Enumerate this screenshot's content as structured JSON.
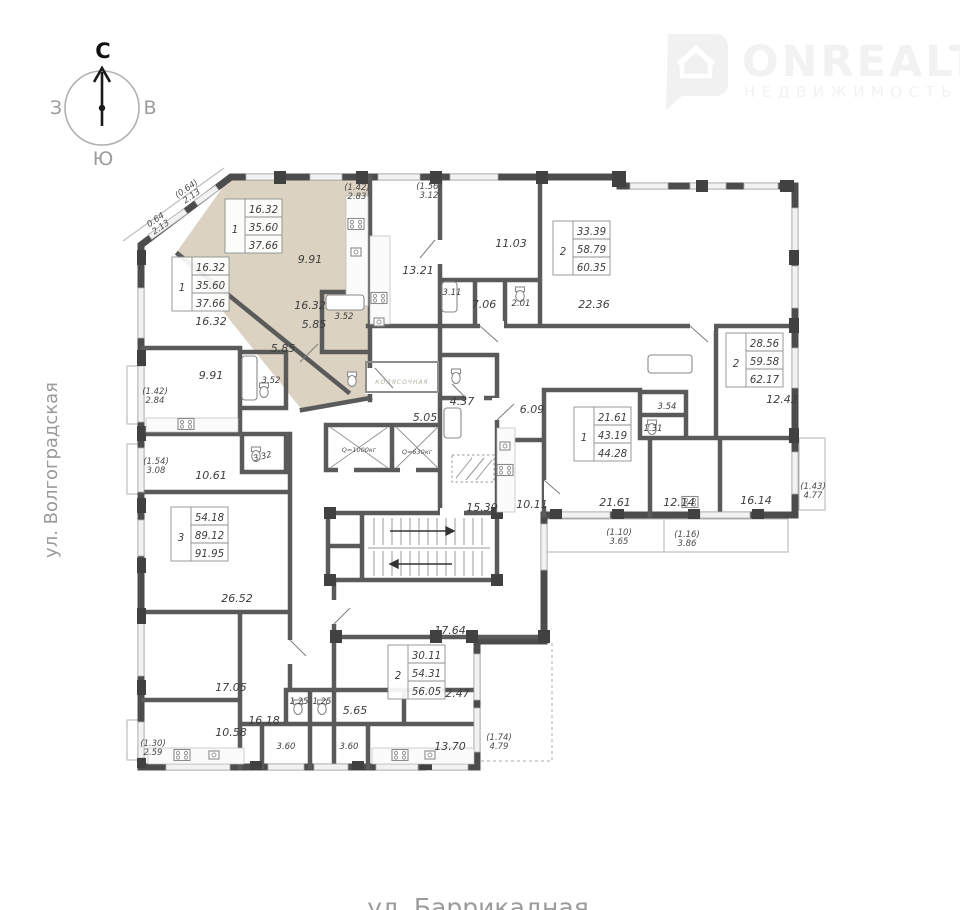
{
  "compass": {
    "north": "С",
    "east": "В",
    "south": "Ю",
    "west": "З"
  },
  "watermark": {
    "brand": "ONREALT",
    "tagline": "НЕДВИЖИМОСТЬ"
  },
  "streets": {
    "left": "ул. Волгоградская",
    "bottom": "ул. Баррикадная"
  },
  "colors": {
    "wall": "#4c4c4c",
    "highlight": "#dbd2c2",
    "label": "#3e3e3c",
    "muted": "#9b9b9b"
  },
  "apartments": {
    "a": {
      "rooms": "1",
      "living": "16.32",
      "area": "35.60",
      "total": "37.66"
    },
    "b": {
      "rooms": "1",
      "living": "16.32",
      "area": "35.60",
      "total": "37.66"
    },
    "c": {
      "rooms": "2",
      "living": "33.39",
      "area": "58.79",
      "total": "60.35"
    },
    "d": {
      "rooms": "2",
      "living": "28.56",
      "area": "59.58",
      "total": "62.17"
    },
    "e": {
      "rooms": "1",
      "living": "21.61",
      "area": "43.19",
      "total": "44.28"
    },
    "f": {
      "rooms": "2",
      "living": "30.11",
      "area": "54.31",
      "total": "56.05"
    },
    "g": {
      "rooms": "3",
      "living": "54.18",
      "area": "89.12",
      "total": "91.95"
    }
  },
  "rooms": {
    "a_living": "16.32",
    "a_kitchen": "9.91",
    "a_hall": "5.85",
    "a_bath": "3.52",
    "b_room": "16.32",
    "b_kitchen": "9.91",
    "b_hall": "5.85",
    "b_bath": "3.52",
    "c_kitchen": "13.21",
    "c_bedroom": "11.03",
    "c_bath": "3.11",
    "c_hall": "7.06",
    "c_wc": "2.01",
    "c_living": "22.36",
    "d_room1": "12.42",
    "d_kitchen": "12.14",
    "d_living": "16.14",
    "e_bath": "3.54",
    "e_wc": "1.31",
    "e_hall": "6.09",
    "e_kitchen": "10.11",
    "e_living": "21.61",
    "f_room1": "17.64",
    "f_room2": "12.47",
    "f_kitchen": "13.70",
    "f_hall": "5.65",
    "f_bath": "3.60",
    "f_wc": "1.25",
    "g_kitchen_top": "10.61",
    "g_room1": "26.52",
    "g_room2": "17.05",
    "g_kitchen": "10.58",
    "g_hall": "16.18",
    "g_bath": "3.60",
    "g_wc": "1.25",
    "g_bath2": "3.32",
    "core_bath": "4.37",
    "core_hall": "5.05",
    "core_corridor": "15.30"
  },
  "balconies": {
    "chamfer_in": {
      "l1": "(0.64)",
      "l2": "2.13"
    },
    "chamfer_out": {
      "l1": "0.64",
      "l2": "2.13"
    },
    "a_top": {
      "l1": "(1.42)",
      "l2": "2.83"
    },
    "c_top": {
      "l1": "(1.56)",
      "l2": "3.12"
    },
    "b_left": {
      "l1": "(1.42)",
      "l2": "2.84"
    },
    "g_left": {
      "l1": "(1.54)",
      "l2": "3.08"
    },
    "g_left2": {
      "l1": "(1.30)",
      "l2": "2.59"
    },
    "d_right": {
      "l1": "(1.43)",
      "l2": "4.77"
    },
    "e_bottom1": {
      "l1": "(1.10)",
      "l2": "3.65"
    },
    "e_bottom2": {
      "l1": "(1.16)",
      "l2": "3.86"
    },
    "f_right": {
      "l1": "(1.74)",
      "l2": "4.79"
    }
  },
  "core": {
    "lift1": "Q=1000кг",
    "lift2": "Q=630кг",
    "stroller": "КОЛЯСОЧНАЯ"
  }
}
